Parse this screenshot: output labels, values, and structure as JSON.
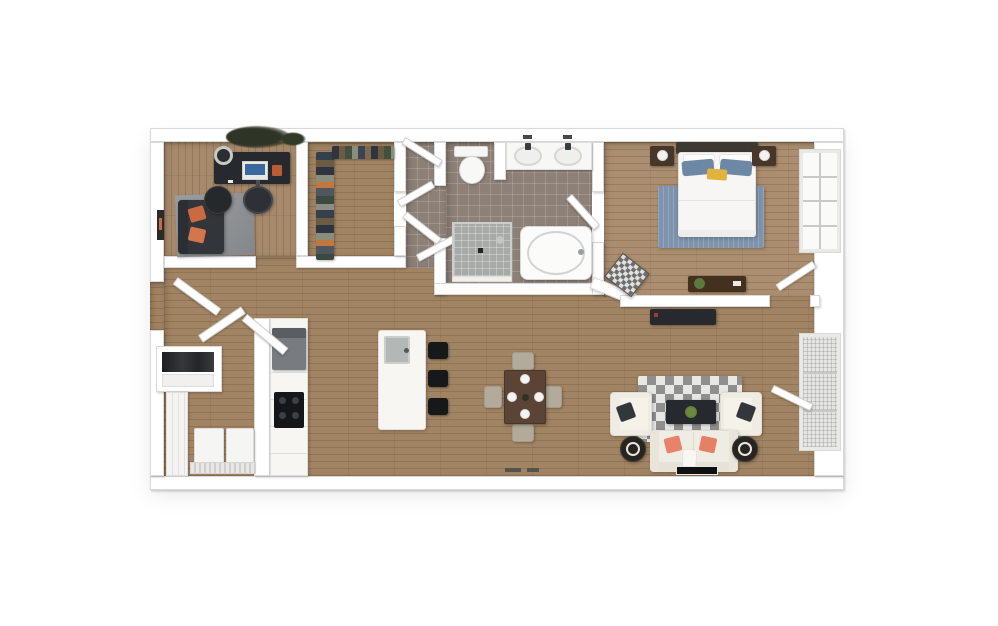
{
  "page": {
    "background": "#ffffff",
    "content_type": "3d-apartment-floor-plan-rendering",
    "text": ""
  },
  "palette": {
    "pageBg": "#ffffff",
    "wall": "#ffffff",
    "wallEdge": "#d9d9d9",
    "woodMain": "#a18463",
    "woodOffice": "#a78a6b",
    "woodBedroom": "#ab8e70",
    "plankLine": "rgba(78,50,24,0.20)",
    "tile": "#8d8076",
    "tileLine": "rgba(255,255,255,0.16)",
    "shower": "#a7aaa7",
    "darkFurn": "#26292e",
    "black": "#17181a",
    "steel": "#787c80",
    "steelDark": "#5a5e62",
    "orange": "#c96a41",
    "coral": "#e8826b",
    "cream": "#efece3",
    "creamEdge": "#dfdcd2",
    "grayRug": "#8f9294",
    "blueRug": "#7e93ac",
    "bluePillow": "#6d88a5",
    "accentYellow": "#dfb33c",
    "headboard": "#3f3933",
    "nightstandBrown": "#47362a",
    "consoleBrown": "#43301f",
    "tableBrown": "#5b4335",
    "chairBeige": "#b2aa9a",
    "plantGreen": "#5d7a3a",
    "checkA": "#8f8f8f",
    "checkB": "#e7e7e5",
    "white": "#f7f6f3",
    "screenBlue": "#3a69a0"
  },
  "floorplan": {
    "rooms": [
      {
        "name": "office-den",
        "floor": "wood",
        "furniture": [
          "ceiling-plant",
          "desk",
          "monitor",
          "desk-accessory",
          "desk-chair",
          "round-stool",
          "loveseat",
          "orange-throw-pillow",
          "orange-throw-pillow",
          "round-side-table",
          "gray-area-rug",
          "wall-art"
        ]
      },
      {
        "name": "walk-in-closet",
        "floor": "wood",
        "furniture": [
          "hanging-clothes-left-rail",
          "hanging-clothes-top-rail",
          "closet-door"
        ]
      },
      {
        "name": "hallway",
        "floor": "tile",
        "furniture": [
          "open-door",
          "open-door",
          "open-door",
          "open-door"
        ]
      },
      {
        "name": "bathroom",
        "floor": "tile",
        "furniture": [
          "toilet",
          "privacy-partition",
          "double-sink-vanity",
          "wall-faucets",
          "walk-in-shower",
          "shower-drain",
          "soaking-tub",
          "door-to-bedroom"
        ]
      },
      {
        "name": "bedroom",
        "floor": "wood",
        "furniture": [
          "headboard",
          "bed-white-duvet",
          "blue-pillow",
          "blue-pillow",
          "accent-pillow-yellow",
          "nightstand-with-lamp",
          "nightstand-with-lamp",
          "blue-area-rug",
          "checkered-bench",
          "console-table-with-plant",
          "window",
          "entry-door"
        ]
      },
      {
        "name": "kitchen",
        "floor": "wood",
        "furniture": [
          "refrigerator",
          "counter-run",
          "cooktop",
          "island-with-sink",
          "bar-stool",
          "bar-stool",
          "bar-stool"
        ]
      },
      {
        "name": "dining-area",
        "floor": "wood",
        "furniture": [
          "square-dining-table",
          "place-setting",
          "place-setting",
          "place-setting",
          "place-setting",
          "centerpiece",
          "dining-chair",
          "dining-chair",
          "dining-chair",
          "dining-chair"
        ]
      },
      {
        "name": "living-room",
        "floor": "wood",
        "furniture": [
          "checkered-area-rug",
          "cream-sofa",
          "coral-throw-pillow",
          "coral-throw-pillow",
          "white-throw",
          "armchair",
          "armchair",
          "dark-accent-pillow",
          "dark-accent-pillow",
          "coffee-table-with-plant",
          "round-side-table",
          "round-side-table",
          "tv-console",
          "wall-tv",
          "patio-glass-door",
          "floor-vent"
        ]
      },
      {
        "name": "laundry-closet",
        "floor": "wood",
        "furniture": [
          "sliding-door",
          "washer",
          "dryer",
          "vent-grille"
        ]
      },
      {
        "name": "entry-vestibule",
        "floor": "wood",
        "furniture": [
          "entry-door",
          "coat-closet"
        ]
      }
    ]
  }
}
